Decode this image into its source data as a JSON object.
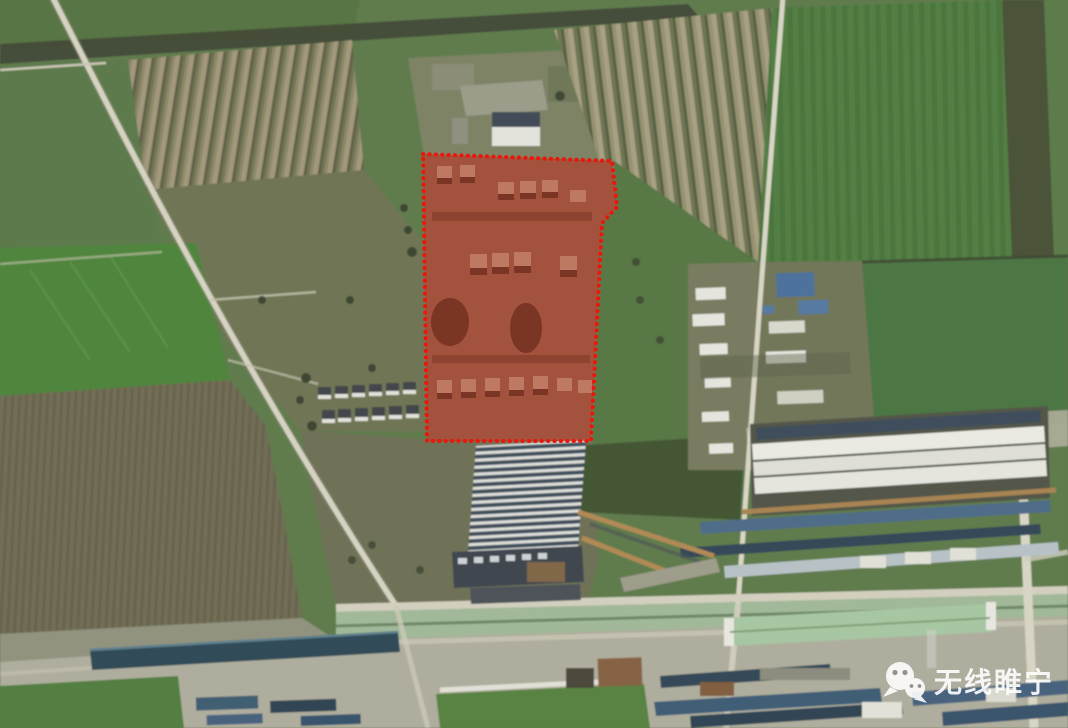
{
  "image": {
    "type": "satellite-aerial-photo",
    "width": 1068,
    "height": 728,
    "scene": "Farmland and town aerial view with a highlighted village plot"
  },
  "annotation": {
    "shape": "dotted-outline-polygon",
    "points": "423,154 612,161 617,207 602,223 591,441 427,441",
    "stroke_color": "#ee1408",
    "fill_color": "#b81808",
    "fill_opacity": 0.46,
    "dot_width": 4,
    "dot_spacing": 6.3
  },
  "watermark": {
    "text": "无线睢宁",
    "icon": "wechat-icon",
    "text_color": "#ffffff",
    "opacity": 0.9
  },
  "palette": {
    "field_green": "#5d784a",
    "bright_green": "#4b8338",
    "plowed_olive": "#6f6b53",
    "stripe_tan": "#a0977a",
    "road_light": "#d6d3c2",
    "tree_dark": "#3f4733",
    "roof_blue": "#4a6f9a",
    "roof_teal": "#2e4854",
    "warehouse_white": "#ebebe3",
    "canal_green": "#9fb896"
  }
}
